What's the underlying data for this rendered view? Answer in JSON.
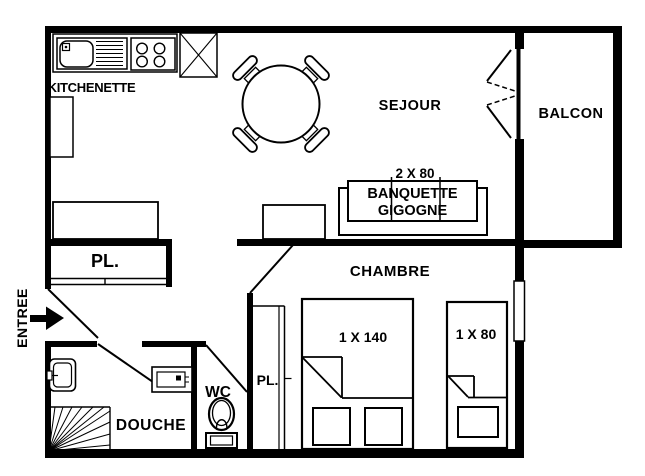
{
  "title": "Apartment floor plan",
  "colors": {
    "ink": "#000000",
    "paper": "#ffffff"
  },
  "rooms": {
    "kitchenette": "KITCHENETTE",
    "sejour": "SEJOUR",
    "balcon": "BALCON",
    "chambre": "CHAMBRE",
    "douche": "DOUCHE",
    "wc": "WC",
    "entree": "ENTREE",
    "closet_hall": "PL.",
    "closet_chambre": "PL."
  },
  "furniture": {
    "banquette_size": "2 X 80",
    "banquette_name_line1": "BANQUETTE",
    "banquette_name_line2": "GIGOGNE",
    "bed_double_size": "1 X 140",
    "bed_single_size": "1 X 80"
  }
}
